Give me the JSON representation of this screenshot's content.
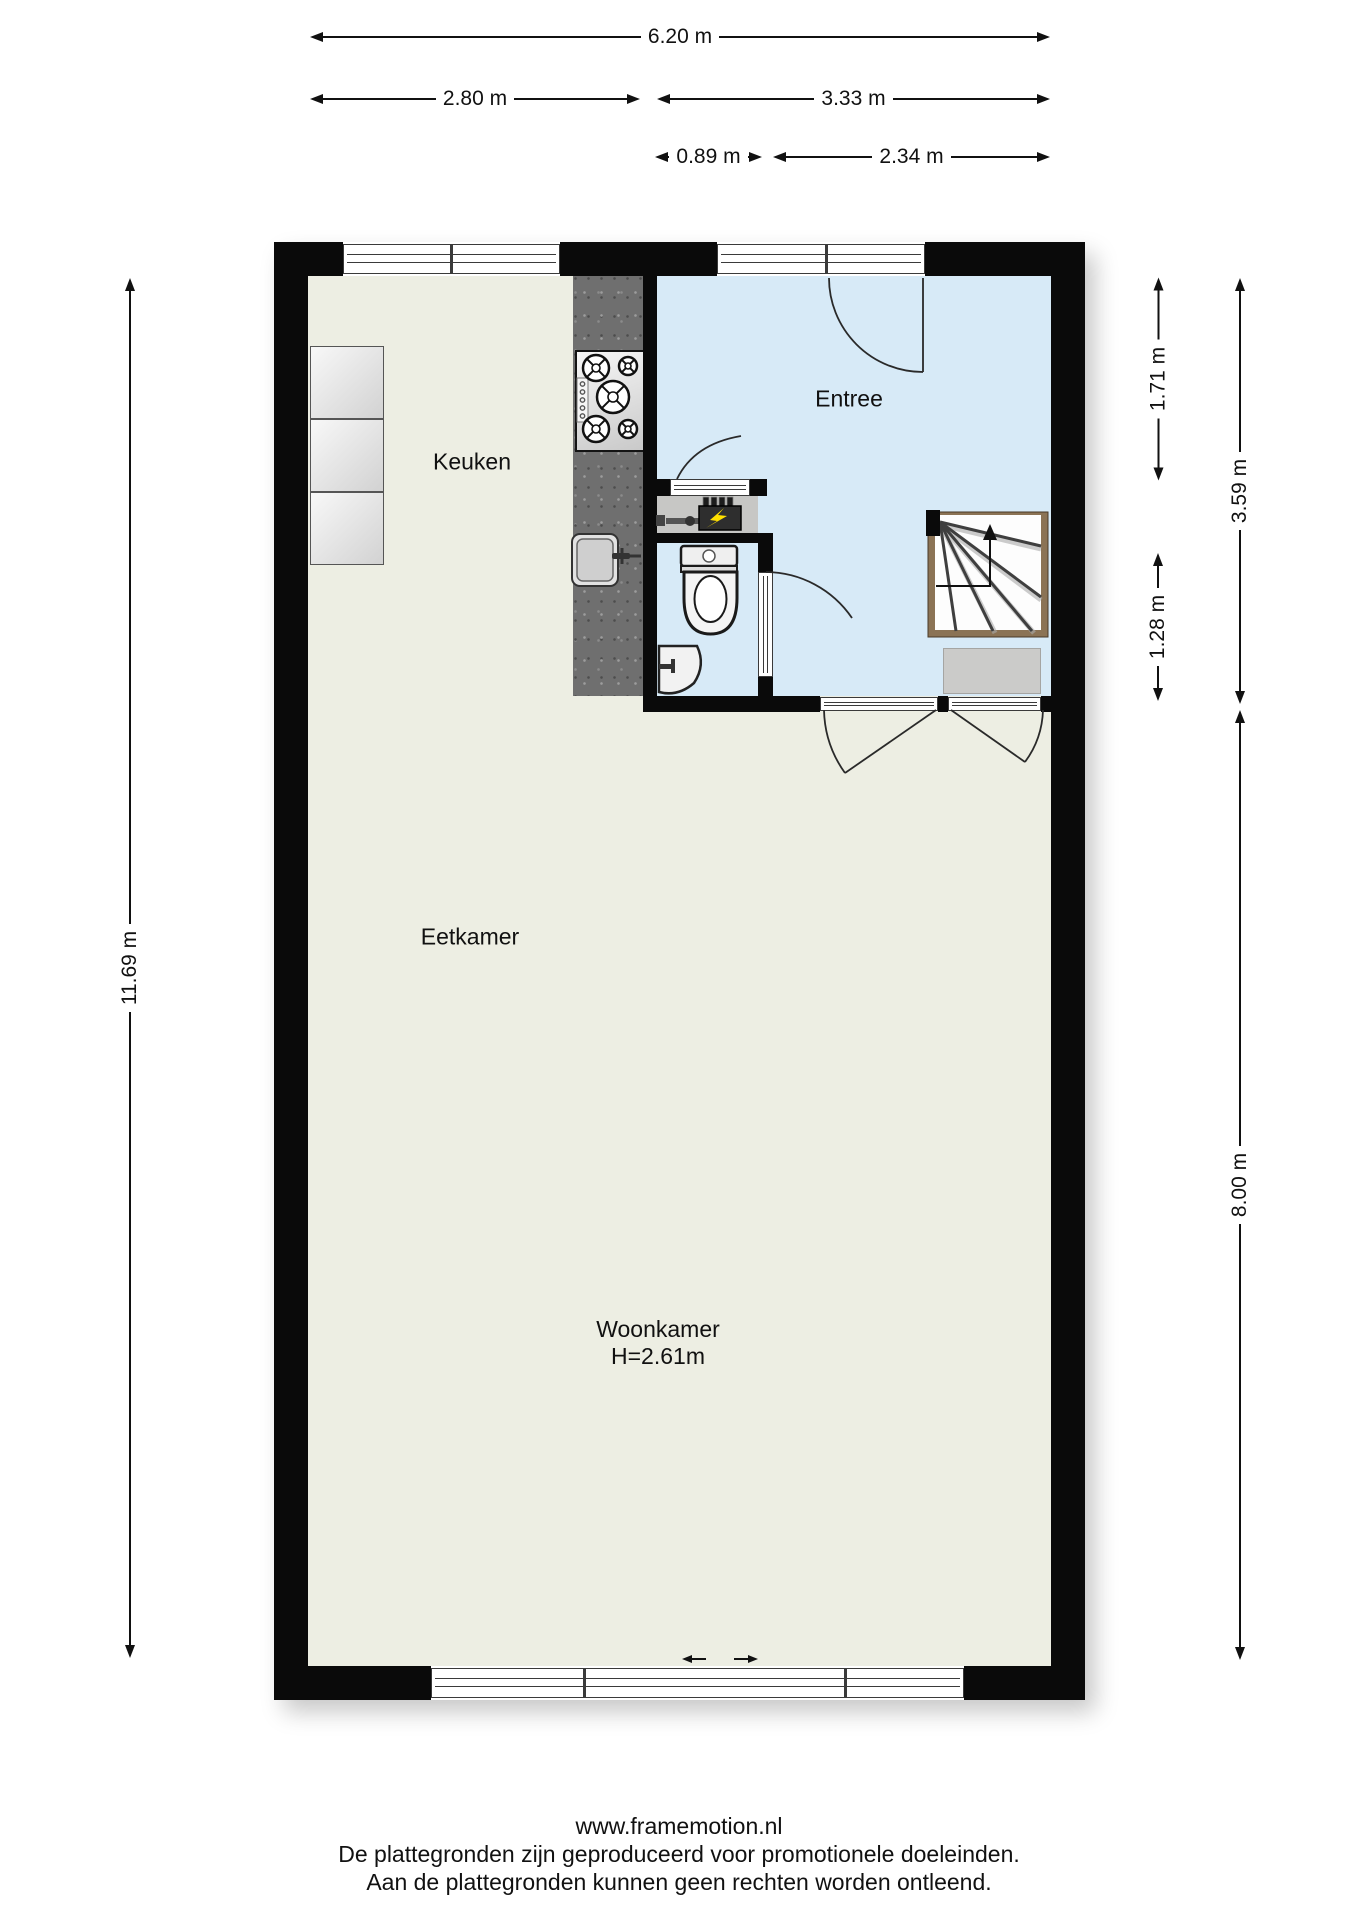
{
  "floorplan": {
    "rooms": {
      "keuken": "Keuken",
      "entree": "Entree",
      "eetkamer": "Eetkamer",
      "woonkamer": "Woonkamer",
      "woonkamer_height": "H=2.61m"
    },
    "dimensions": {
      "top_total": "6.20 m",
      "top_left": "2.80 m",
      "top_right": "3.33 m",
      "inner_left": "0.89 m",
      "inner_right": "2.34 m",
      "left_total": "11.69 m",
      "right_top": "1.71 m",
      "right_mid": "1.28 m",
      "right_upper_total": "3.59 m",
      "right_lower_total": "8.00 m"
    },
    "colors": {
      "wall": "#0A0A0A",
      "floor_main": "#EDEEE3",
      "floor_entree": "#D7EAF7",
      "counter": "#6F6F6F",
      "stair_wood": "#8B7355",
      "meter_accent": "#FFE000"
    }
  },
  "footer": {
    "website": "www.framemotion.nl",
    "line1": "De plattegronden zijn geproduceerd voor promotionele doeleinden.",
    "line2": "Aan de plattegronden kunnen geen rechten worden ontleend."
  }
}
